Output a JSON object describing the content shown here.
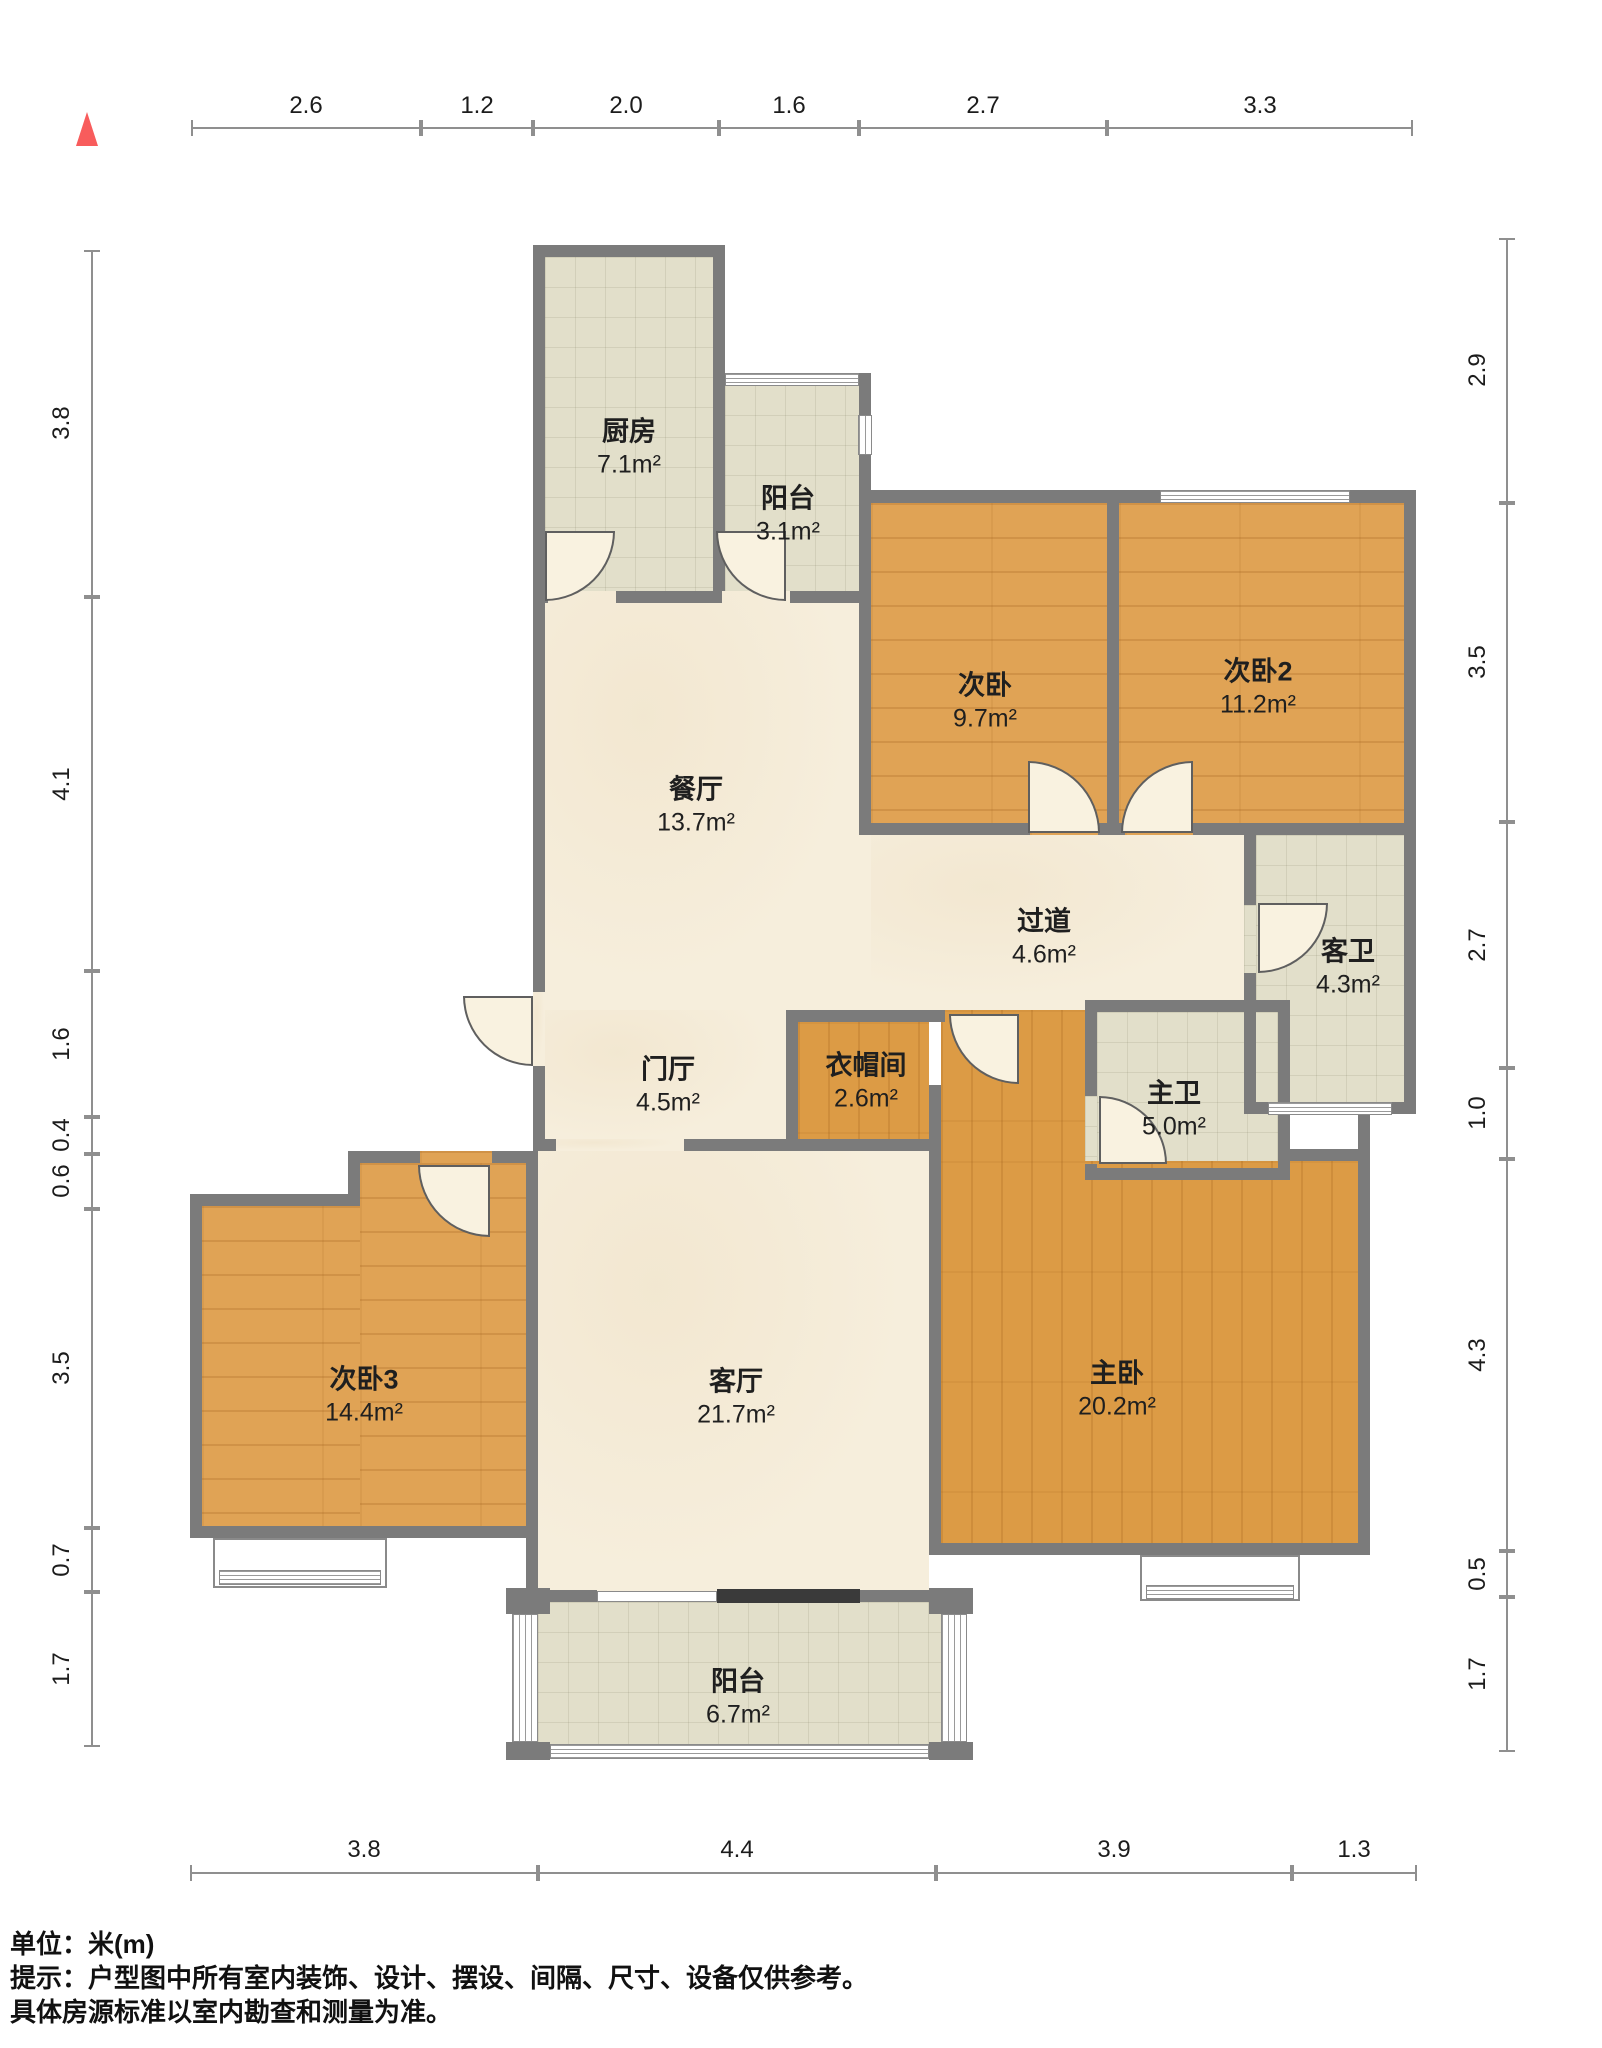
{
  "rulers": {
    "top": [
      "2.6",
      "1.2",
      "2.0",
      "1.6",
      "2.7",
      "3.3"
    ],
    "bottom": [
      "3.8",
      "4.4",
      "3.9",
      "1.3"
    ],
    "left": [
      "3.8",
      "4.1",
      "1.6",
      "0.4",
      "0.6",
      "3.5",
      "0.7",
      "1.7"
    ],
    "right": [
      "2.9",
      "3.5",
      "2.7",
      "1.0",
      "4.3",
      "0.5",
      "1.7"
    ]
  },
  "rooms": {
    "kitchen": {
      "name": "厨房",
      "area": "7.1m²"
    },
    "balcony_top": {
      "name": "阳台",
      "area": "3.1m²"
    },
    "bedroom2a": {
      "name": "次卧",
      "area": "9.7m²"
    },
    "bedroom2b": {
      "name": "次卧2",
      "area": "11.2m²"
    },
    "dining": {
      "name": "餐厅",
      "area": "13.7m²"
    },
    "hallway": {
      "name": "过道",
      "area": "4.6m²"
    },
    "guest_bath": {
      "name": "客卫",
      "area": "4.3m²"
    },
    "foyer": {
      "name": "门厅",
      "area": "4.5m²"
    },
    "closet": {
      "name": "衣帽间",
      "area": "2.6m²"
    },
    "master_bath": {
      "name": "主卫",
      "area": "5.0m²"
    },
    "bedroom3": {
      "name": "次卧3",
      "area": "14.4m²"
    },
    "living": {
      "name": "客厅",
      "area": "21.7m²"
    },
    "master_bedroom": {
      "name": "主卧",
      "area": "20.2m²"
    },
    "balcony_bottom": {
      "name": "阳台",
      "area": "6.7m²"
    }
  },
  "footer": {
    "unit": "单位：米(m)",
    "tip1": "提示：户型图中所有室内装饰、设计、摆设、间隔、尺寸、设备仅供参考。",
    "tip2": "具体房源标准以室内勘查和测量为准。"
  },
  "colors": {
    "accent_red": "#f85c5c",
    "wall_gray": "#7b7b7b",
    "wood": "#e0a355",
    "tile": "#e2dfca",
    "marble": "#f6eedc"
  }
}
